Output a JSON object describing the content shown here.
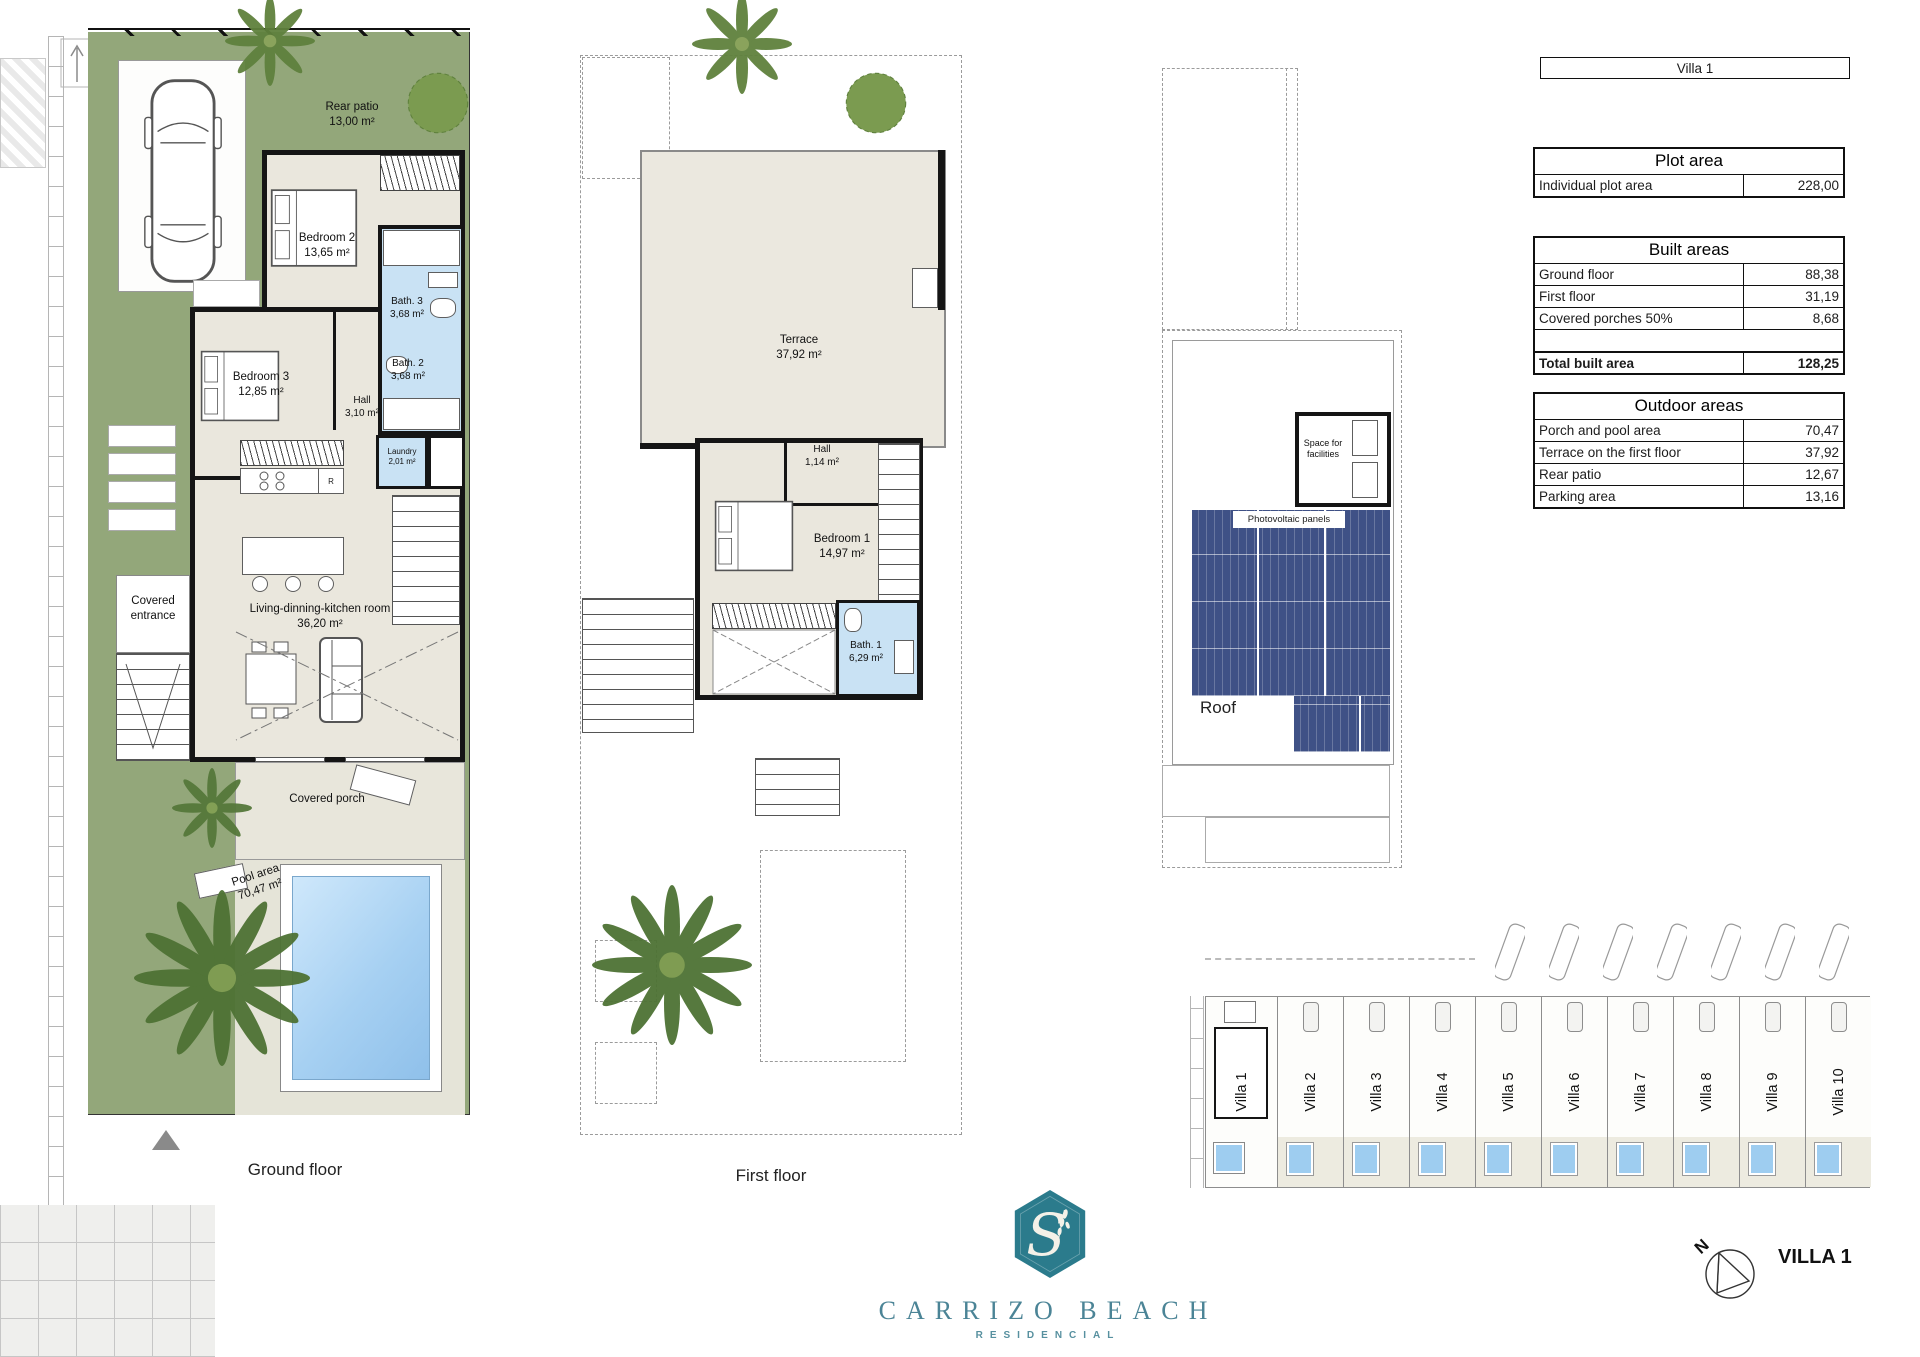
{
  "document": {
    "sheet_title": "Villa 1"
  },
  "tables": {
    "plot": {
      "title": "Plot area",
      "rows": [
        {
          "label": "Individual plot area",
          "value": "228,00"
        }
      ]
    },
    "built": {
      "title": "Built areas",
      "rows": [
        {
          "label": "Ground floor",
          "value": "88,38"
        },
        {
          "label": "First floor",
          "value": "31,19"
        },
        {
          "label": "Covered porches 50%",
          "value": "8,68"
        }
      ],
      "total": {
        "label": "Total built area",
        "value": "128,25"
      }
    },
    "outdoor": {
      "title": "Outdoor areas",
      "rows": [
        {
          "label": "Porch and pool area",
          "value": "70,47"
        },
        {
          "label": "Terrace on the first floor",
          "value": "37,92"
        },
        {
          "label": "Rear patio",
          "value": "12,67"
        },
        {
          "label": "Parking area",
          "value": "13,16"
        }
      ]
    }
  },
  "plans": {
    "ground_floor": {
      "caption": "Ground floor",
      "fridge_letter": "R",
      "rooms": {
        "rear_patio": {
          "name": "Rear patio",
          "area": "13,00 m²"
        },
        "bedroom2": {
          "name": "Bedroom 2",
          "area": "13,65 m²"
        },
        "bath3": {
          "name": "Bath. 3",
          "area": "3,68 m²"
        },
        "bath2": {
          "name": "Bath. 2",
          "area": "3,68 m²"
        },
        "bedroom3": {
          "name": "Bedroom 3",
          "area": "12,85 m²"
        },
        "hall": {
          "name": "Hall",
          "area": "3,10 m²"
        },
        "laundry": {
          "name": "Laundry",
          "area": "2,01 m²"
        },
        "covered_entrance": {
          "name": "Covered entrance"
        },
        "living": {
          "name": "Living-dinning-kitchen room",
          "area": "36,20 m²"
        },
        "covered_porch": {
          "name": "Covered porch"
        },
        "pool_area": {
          "name": "Pool area",
          "area": "70,47 m²"
        }
      }
    },
    "first_floor": {
      "caption": "First floor",
      "rooms": {
        "terrace": {
          "name": "Terrace",
          "area": "37,92 m²"
        },
        "hall": {
          "name": "Hall",
          "area": "1,14 m²"
        },
        "bedroom1": {
          "name": "Bedroom 1",
          "area": "14,97 m²"
        },
        "bath1": {
          "name": "Bath. 1",
          "area": "6,29 m²"
        }
      }
    },
    "roof": {
      "caption": "Roof",
      "labels": {
        "space_for_facilities": "Space for facilities",
        "photovoltaic_panels": "Photovoltaic panels"
      }
    }
  },
  "site_plan": {
    "villas": [
      "Villa 1",
      "Villa 2",
      "Villa 3",
      "Villa 4",
      "Villa 5",
      "Villa 6",
      "Villa 7",
      "Villa 8",
      "Villa 9",
      "Villa 10"
    ]
  },
  "footer": {
    "brand": "CARRIZO BEACH",
    "subtitle": "RESIDENCIAL",
    "villa_label": "VILLA 1",
    "north_letter": "N",
    "logo_letter": "S"
  },
  "colors": {
    "garden_green": "#93a77a",
    "floor_beige": "#eae7dd",
    "bath_blue": "#c9e2f4",
    "pool_blue": "#9ecdf0",
    "wall_black": "#151515",
    "solar_panel_navy": "#3f5186",
    "brand_teal": "#2b7b8c"
  }
}
